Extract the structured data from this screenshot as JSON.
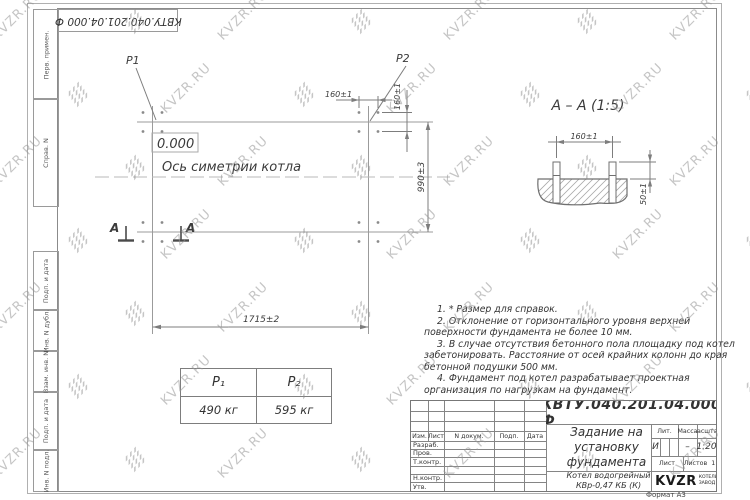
{
  "watermark": {
    "text": "KVZR.RU"
  },
  "stamp_top": "КВТУ.040.201.04.000  Ф",
  "frame": {
    "labels": [
      "Перв. примен.",
      "Справ. N",
      "Подп. и дата",
      "Инв. N дубл.",
      "Взам. инв. N",
      "Подп. и дата",
      "Инв. N подл."
    ]
  },
  "plan": {
    "p1_label": "P1",
    "p2_label": "P2",
    "level_mark": "0.000",
    "axis_label": "Ось симетрии котла",
    "dim_width": "1715±2",
    "dim_height": "990±3",
    "dim_bolt_spacing_h": "160±1",
    "dim_bolt_spacing_v": "160±1",
    "section_letter_1": "А",
    "section_letter_2": "А"
  },
  "section": {
    "title": "А – А (1:5)",
    "dim_spacing": "160±1",
    "dim_protrusion": "50±1"
  },
  "notes": {
    "items": [
      "1. * Размер для справок.",
      "2. Отклонение от горизонтального уровня верхней поверхности фундамента не более 10 мм.",
      "3. В случае отсутствия бетонного пола площадку под котел забетонировать. Расстояние от осей крайних колонн до края бетонной подушки 500 мм.",
      "4. Фундамент под котел разрабатывает проектная организация по нагрузкам на фундамент."
    ]
  },
  "load_table": {
    "headers": [
      "P₁",
      "P₂"
    ],
    "values": [
      "490 кг",
      "595 кг"
    ]
  },
  "title_block": {
    "doc_number": "КВТУ.040.201.04.000 Ф",
    "title": "Задание на установку фундамента",
    "product": "Котел водогрейный КВр-0,47 КБ (К)",
    "col_izm": "Изм.",
    "col_list": "Лист",
    "col_doc": "N докум.",
    "col_podp": "Подп.",
    "col_data": "Дата",
    "rows": [
      "Разраб.",
      "Пров.",
      "Т.контр.",
      "",
      "Н.контр.",
      "Утв."
    ],
    "lit_label": "Лит.",
    "lit_value": "И",
    "massa_label": "Масса",
    "massa_value": "–",
    "scale_label": "Масштаб",
    "scale_value": "1:20",
    "sheet_label": "Лист",
    "sheets_label": "Листов",
    "sheets_value": "1",
    "logo_text": "KVZR",
    "logo_sub1": "КОТЕЛЬНЫЙ",
    "logo_sub2": "ЗАВОД РЭП",
    "format_note": "Формат А3"
  }
}
